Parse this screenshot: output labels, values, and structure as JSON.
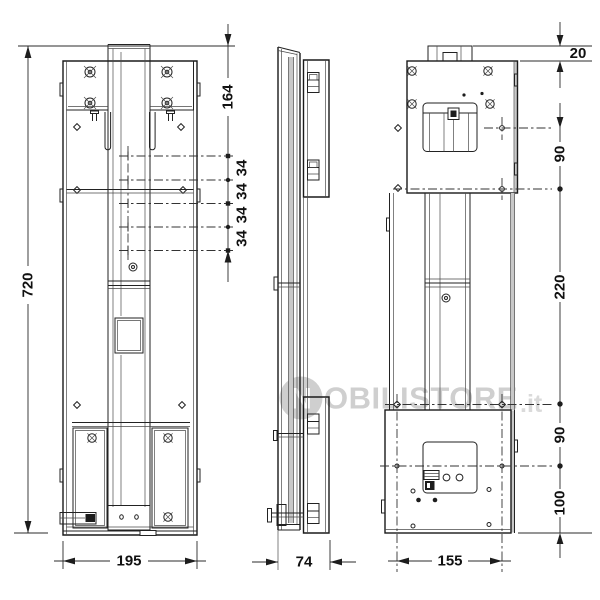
{
  "drawing": {
    "kind": "technical-drawing-three-views",
    "dims": {
      "front_height": "720",
      "front_width": "195",
      "front_top_offset": "164",
      "hole_spacing": [
        "34",
        "34",
        "34",
        "34"
      ],
      "side_depth": "74",
      "back_width": "155",
      "back_top_gap": "20",
      "back_upper_pitch": "90",
      "back_mid_pitch": "220",
      "back_lower_pitch": "90",
      "back_bottom_pitch": "100"
    },
    "watermark": {
      "logo_letter": "N",
      "text": "OBILISTORE",
      "tld": ".it"
    },
    "colors": {
      "line": "#222222",
      "shade": "#c8c8c8",
      "watermark": "#c7c7c7",
      "background": "#ffffff"
    }
  }
}
